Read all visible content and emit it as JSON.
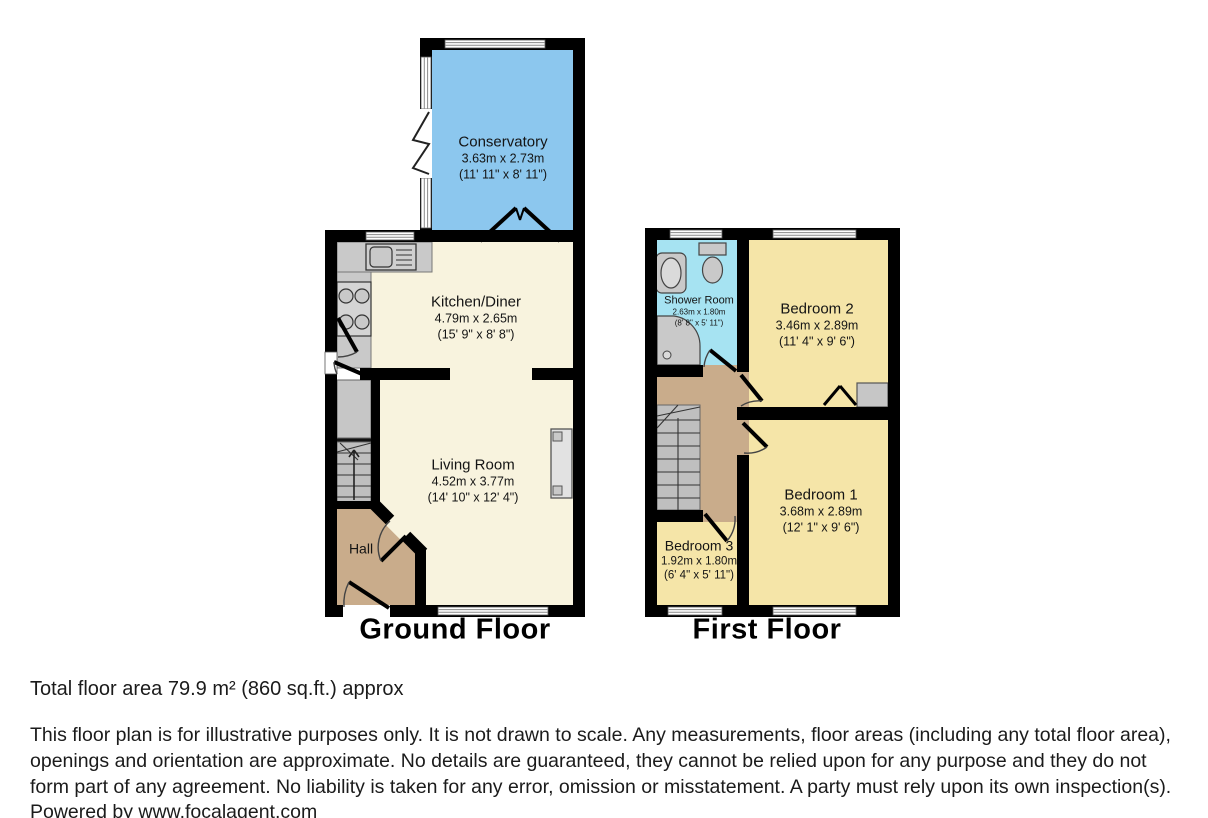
{
  "colors": {
    "wall": "#000000",
    "conservatory_blue": "#8CC7EE",
    "cream": "#F8F3DE",
    "tan": "#C9AC8B",
    "shower_cyan": "#A6E3F2",
    "bedroom_yellow": "#F5E5A8"
  },
  "ground_floor": {
    "label": "Ground Floor",
    "rooms": {
      "conservatory": {
        "name": "Conservatory",
        "dims_m": "3.63m x 2.73m",
        "dims_ft": "(11' 11\" x 8' 11\")"
      },
      "kitchen_diner": {
        "name": "Kitchen/Diner",
        "dims_m": "4.79m x 2.65m",
        "dims_ft": "(15' 9\" x 8' 8\")"
      },
      "living_room": {
        "name": "Living Room",
        "dims_m": "4.52m x 3.77m",
        "dims_ft": "(14' 10\" x 12' 4\")"
      },
      "hall": {
        "name": "Hall"
      }
    }
  },
  "first_floor": {
    "label": "First Floor",
    "rooms": {
      "shower_room": {
        "name": "Shower Room",
        "dims_m": "2.63m x 1.80m",
        "dims_ft": "(8' 8\" x 5' 11\")"
      },
      "bedroom_2": {
        "name": "Bedroom 2",
        "dims_m": "3.46m x 2.89m",
        "dims_ft": "(11' 4\" x 9' 6\")"
      },
      "bedroom_1": {
        "name": "Bedroom 1",
        "dims_m": "3.68m x 2.89m",
        "dims_ft": "(12' 1\" x 9' 6\")"
      },
      "bedroom_3": {
        "name": "Bedroom 3",
        "dims_m": "1.92m x 1.80m",
        "dims_ft": "(6' 4\" x 5' 11\")"
      }
    }
  },
  "footer": {
    "total_area": "Total floor area 79.9 m² (860 sq.ft.) approx",
    "disclaimer": "This floor plan is for illustrative purposes only. It is not drawn to scale. Any measurements, floor areas (including any total floor area), openings and orientation are approximate. No details are guaranteed, they cannot be relied upon for any purpose and they do not form part of any agreement. No liability is taken for any error, omission or misstatement. A party must rely upon its own inspection(s). Powered by www.focalagent.com"
  }
}
